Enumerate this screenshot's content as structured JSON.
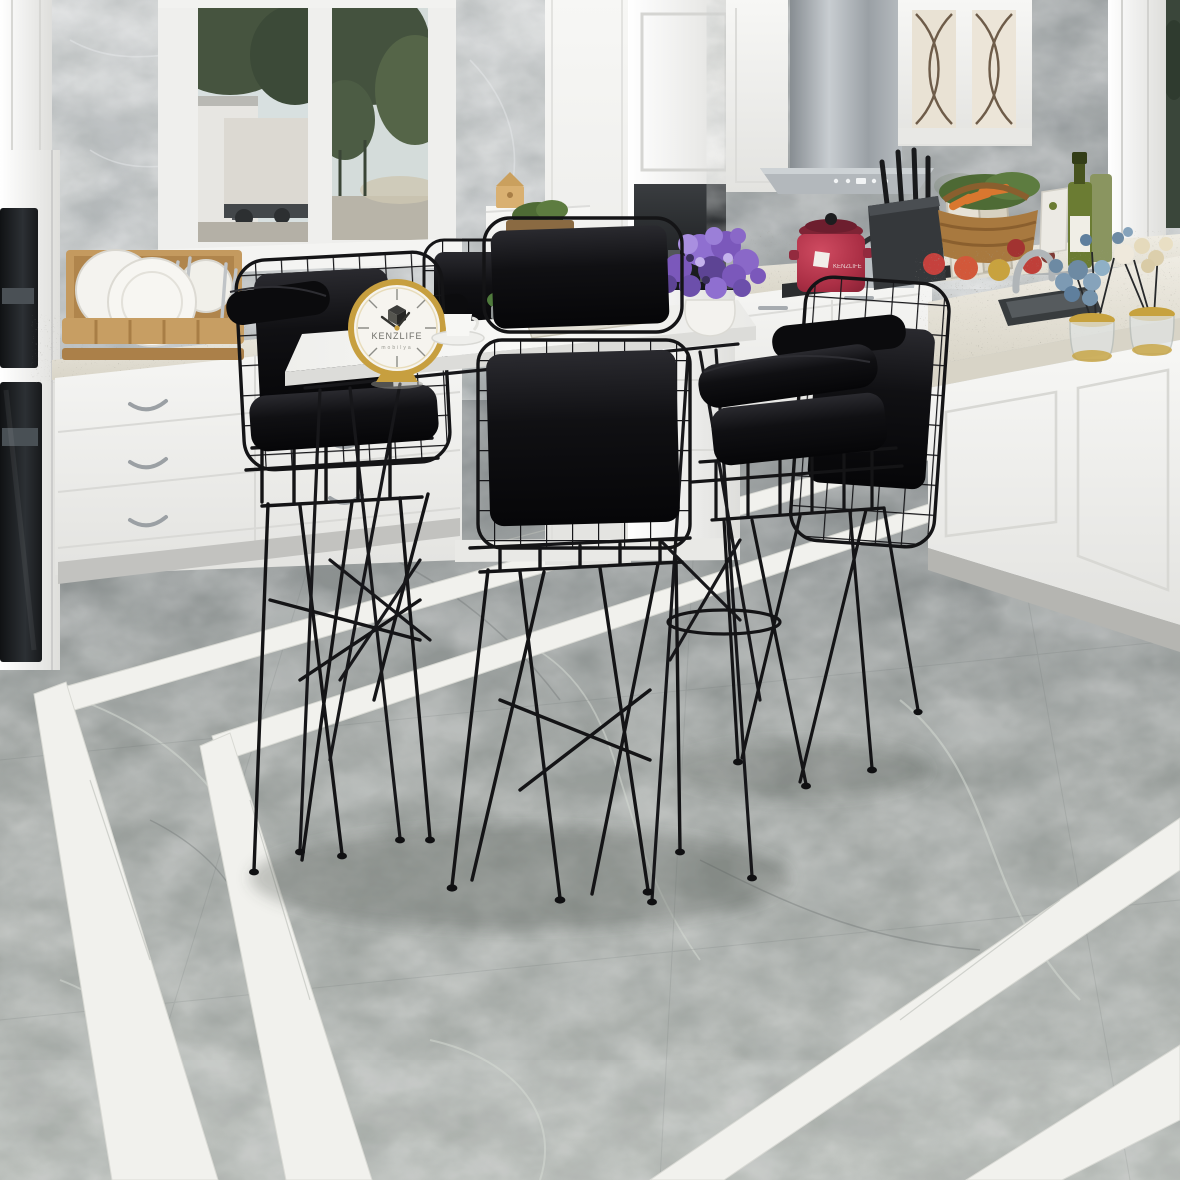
{
  "scene": {
    "type": "kitchen-interior-product-render",
    "subject": "Black wire-frame bar stool set with white bar table",
    "setting": "Modern white kitchen, gray marble walls, gray marble floor with white marble inlay border stripes"
  },
  "clock": {
    "brand": "KENZLIFE",
    "subtext": "mobilya"
  },
  "cookware": {
    "pot_label": "KENZLIFE"
  },
  "palette": {
    "wall_marble": "#b7bbbc",
    "cabinet_white": "#f2f2f0",
    "counter_granite": "#e9e6dd",
    "floor_marble": "#979c98",
    "floor_inlay_white": "#f1f1ed",
    "chair_black": "#131315",
    "table_top": "#f4f4f2",
    "clock_gold": "#c79f3f",
    "flowers_purple": "#8465c6",
    "flowers_blue": "#7d9ab3",
    "flowers_cream": "#e5dabc",
    "pot_red": "#b03347",
    "wood_tan": "#c49a5f",
    "olive_green": "#6b7c33",
    "appliance_steel": "#a9aeb2",
    "oven_black": "#1a1c1e"
  }
}
